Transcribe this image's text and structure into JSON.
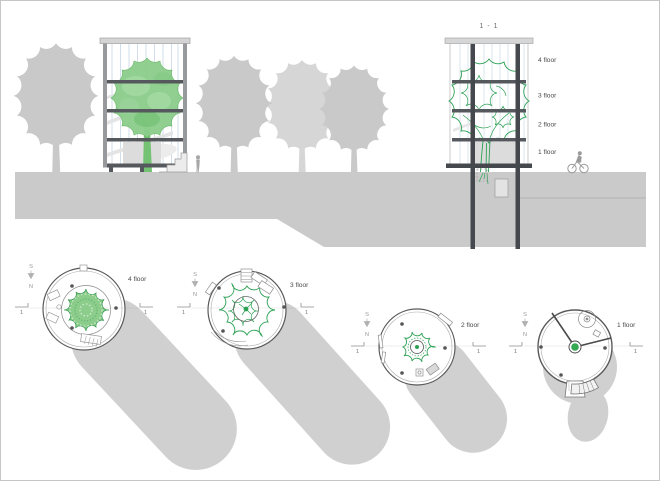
{
  "drawing": {
    "section_title": "1 - 1",
    "section_floor_labels": [
      "4 floor",
      "3 floor",
      "2 floor",
      "1 floor"
    ],
    "plan_labels": [
      "4 floor",
      "3 floor",
      "2 floor",
      "1 floor"
    ],
    "compass": {
      "south": "S",
      "north": "N"
    },
    "section_marker_number": "1"
  },
  "colors": {
    "tree_gray": "#c9c9c9",
    "tree_gray_light": "#d6d6d6",
    "ground_gray": "#cacaca",
    "shadow_gray": "#d0d0d0",
    "frame_dark": "#55585c",
    "glass_blue": "#c7d8e5",
    "green_fill": "#8ccd8c",
    "green_line": "#2da155",
    "label_text": "#4a4a4a"
  }
}
